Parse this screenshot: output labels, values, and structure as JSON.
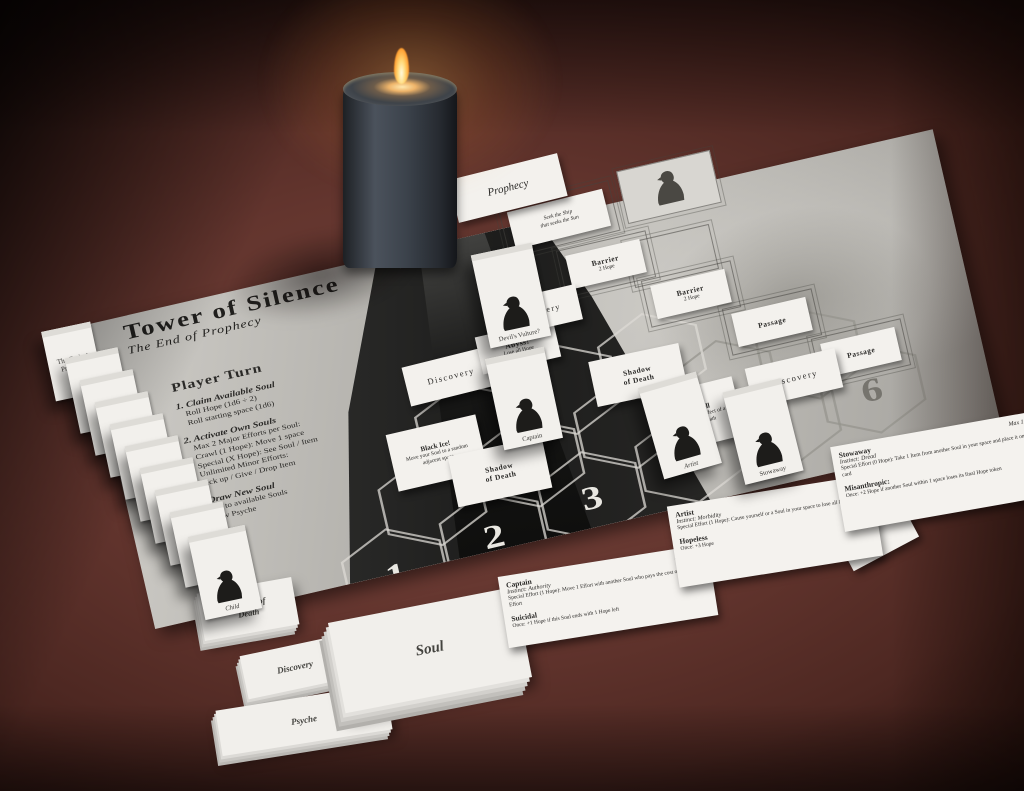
{
  "board": {
    "title": "Tower of Silence",
    "subtitle": "The End of Prophecy",
    "tower_label": "Tower",
    "player_turn": {
      "heading": "Player Turn",
      "steps": [
        {
          "title": "1. Claim Available Soul",
          "lines": [
            "Roll Hope (1d6 ÷ 2)",
            "Roll starting space (1d6)"
          ]
        },
        {
          "title": "2. Activate Own Souls",
          "lines": [
            "Max 2 Major Efforts per Soul:",
            "Crawl (1 Hope): Move 1 space",
            "Special (X Hope): See Soul / Item",
            "Unlimited Minor Efforts:",
            "Pick up / Give / Drop Item"
          ]
        },
        {
          "title": "3. Draw New Soul",
          "lines": [
            "Add to available Souls",
            "Draw Psyche"
          ]
        }
      ]
    },
    "hex_numbers": [
      "1",
      "2",
      "3",
      "4",
      "6"
    ]
  },
  "tiles": {
    "prophecy_label": "Prophecy",
    "seek_line1": "Seek the Ship",
    "seek_line2": "that seeks the Sun",
    "barrier_title": "Barrier",
    "barrier_cost": "2 Hope",
    "passage": "Passage",
    "discovery": "Discovery",
    "abyss_title": "Abyss!",
    "abyss_text": "Lose all Hope",
    "shadow_line1": "Shadow",
    "shadow_line2": "of Death",
    "black_ice_title": "Black Ice!",
    "black_ice_text": "Move your Soul to a random adjacent space",
    "ships_bell_title": "Ship's Bell",
    "ships_bell_text": "Once: Ignore the effect of a Shadow of Death"
  },
  "standees": {
    "devils_vulture": "Devil's Vulture?",
    "captain": "Captain",
    "artist": "Artist",
    "stowaway": "Stowaway",
    "child": "Child",
    "end_of_prophecy": "The End of Prophecy"
  },
  "stacks": {
    "shadow_of_death": "Shadow of Death",
    "discovery": "Discovery",
    "psyche": "Psyche",
    "soul": "Soul"
  },
  "reference_cards": {
    "captain": {
      "title": "Captain",
      "instinct": "Instinct: Authority",
      "effort": "Special Effort (1 Hope): Move 1 Effort with another Soul who pays the cost of its own Effort",
      "max": "Max 1 Item",
      "trait": "Suicidal",
      "trait_text": "Once: +1 Hope if this Soul ends with 1 Hope left"
    },
    "artist": {
      "title": "Artist",
      "instinct": "Instinct: Morbidity",
      "effort": "Special Effort (1 Hope): Cause yourself or a Soul in your space to lose all Hope",
      "trait": "Hopeless",
      "trait_text": "Once: +3 Hope"
    },
    "brass_bird": {
      "title": "Brass Bird",
      "text": "Effort (1 Hope): Cause a Soul in an adjacent space to lose all its Hope"
    },
    "stowaway": {
      "title": "Stowaway",
      "instinct": "Instinct: Dread",
      "effort": "Special Effort (0 Hope): Take 1 Item from another Soul in your space and place it on your card",
      "max": "Max 1 Item",
      "trait": "Misanthropic:",
      "trait_text": "Once: +2 Hope if another Soul within 1 space loses its final Hope token"
    }
  },
  "colors": {
    "table": "#5d322b",
    "board_paper": "#c4c2bd",
    "card_white": "#f3f1ed",
    "flame": "#ffb347",
    "ink": "#2b2a28"
  }
}
